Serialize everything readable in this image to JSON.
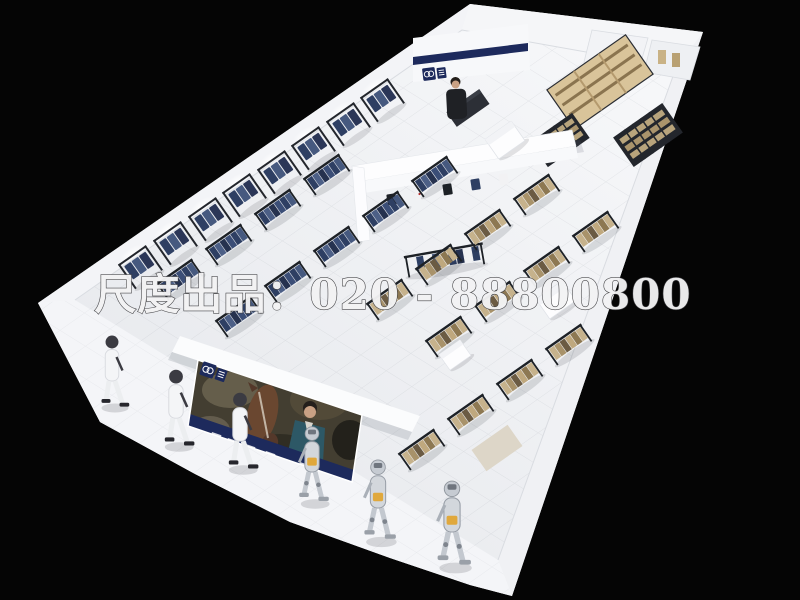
{
  "watermark": {
    "text": "尺度出品：020 - 88800800",
    "color": "#f3f3f4"
  },
  "brand": {
    "navy": "#1d2a5c",
    "logo_icon": "interlocked-rings"
  },
  "palette": {
    "background": "#050505",
    "store_shell": "#f8f9fb",
    "floor": "#edeff2",
    "rack_frame": "#23262c",
    "denim_dark": "#2e3f63",
    "denim_light": "#4c5f86",
    "khaki": "#c6b28c",
    "wood_shelf": "#d9c49a",
    "jacket_teal": "#2d5866",
    "horse_brown": "#6a4730",
    "mannequin_silver": "#d3d7dc",
    "accent_gold": "#e0a83c"
  }
}
